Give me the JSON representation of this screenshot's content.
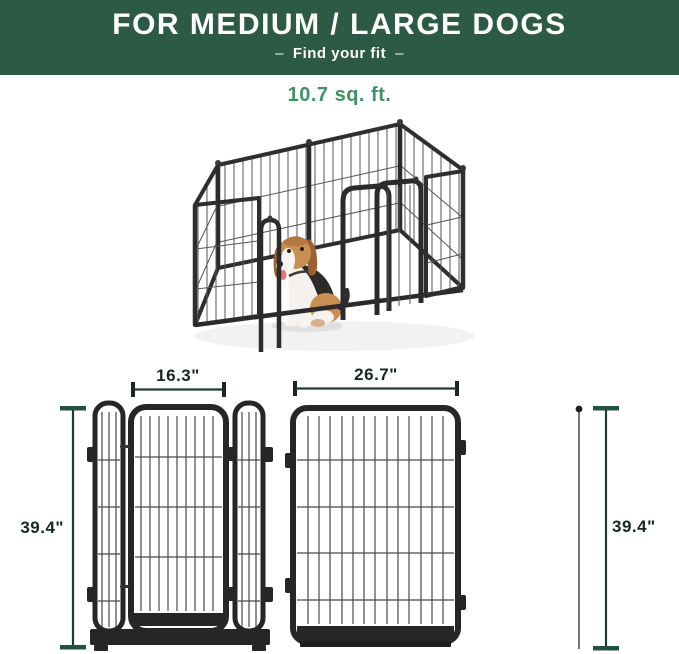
{
  "header": {
    "title": "FOR MEDIUM / LARGE DOGS",
    "subtitle_dash_left": "–",
    "subtitle": "Find your fit",
    "subtitle_dash_right": "–",
    "background_color": "#2d5a44",
    "text_color": "#ffffff"
  },
  "area": {
    "label": "10.7 sq. ft.",
    "color": "#3f9166"
  },
  "hero": {
    "description": "Heavy-duty metal wire dog playpen shown in perspective with gate open and a beagle sitting inside",
    "frame_color": "#2b2b2b",
    "wire_color": "#555555",
    "dog_colors": {
      "coat_tan": "#c98f52",
      "ear_brown": "#9c6132",
      "saddle_dark": "#2e2a28",
      "chest_white": "#f4f1ee",
      "tongue_pink": "#e5737f"
    }
  },
  "diagrams": {
    "dimension_line_color": "#1e3d2e",
    "dimension_cap_color": "#24513c",
    "label_color": "#17271e",
    "panel_color": "#262626",
    "gate_panel": {
      "width_label": "16.3\"",
      "height_label": "39.4\""
    },
    "wide_panel": {
      "width_label": "26.7\"",
      "height_label": "39.4\""
    }
  }
}
